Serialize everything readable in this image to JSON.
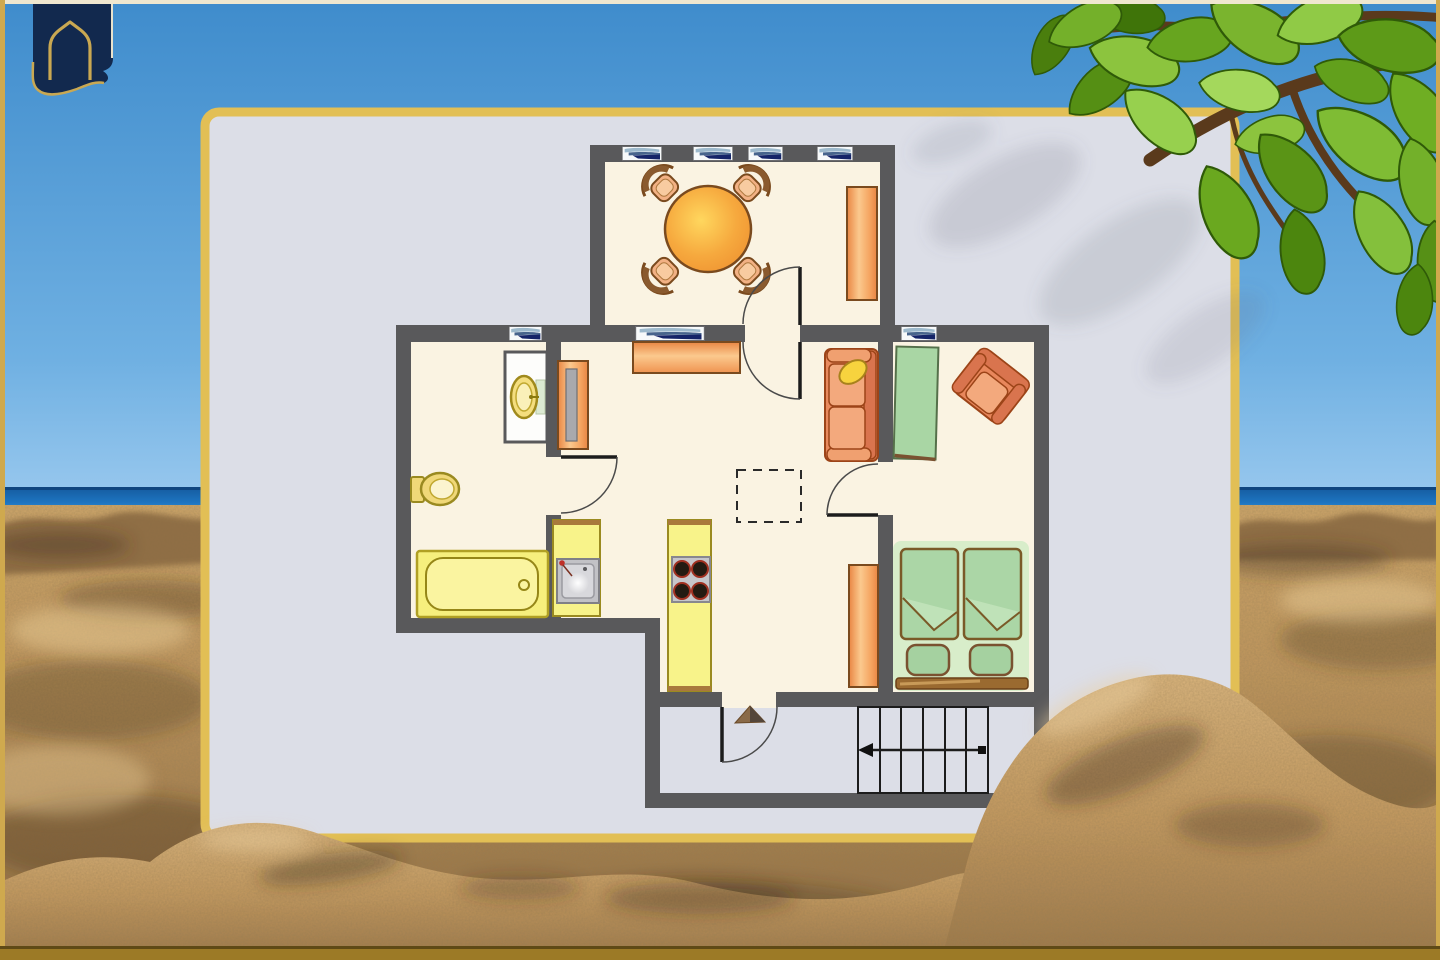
{
  "scene": {
    "description": "sunny beach photo backdrop (blue sky, sea horizon, sandy dunes) with an apartment floor-plan card, tropical leaves top-right and a navy arch logo top-left",
    "background_elements": [
      "sky",
      "sea-horizon",
      "sandy-beach",
      "tree-branch-leaves",
      "leaf-shadow-on-card"
    ],
    "logo": {
      "icon": "arched-banner-logo"
    }
  },
  "colors": {
    "sky_top": "#4390cf",
    "sky_bottom": "#94c4ea",
    "sea": "#1d68b2",
    "sea_horizon_line": "#10457e",
    "sand_light": "#d8b37b",
    "sand_mid": "#c49a62",
    "sand_dark": "#8a6840",
    "card_bg": "#dcdee7",
    "card_border": "#e2bf55",
    "wall": "#59595b",
    "floor": "#faf3e2",
    "line_black": "#1c1c1c",
    "window_navy": "#152468",
    "window_blue": "#9db9cc",
    "furniture_orange": "#ef9350",
    "furniture_outline": "#8a4a1e",
    "green": "#a9d6a4",
    "green_glow": "#d8edca",
    "yellow": "#f6ef8a",
    "metal": "#c2c2c6",
    "leaf_green": "#76b42a",
    "branch_brown": "#5a3a1c",
    "logo_navy": "#12294e",
    "logo_gold": "#c9a852"
  },
  "floor_plan": {
    "style": "hand-tinted 2D apartment plan, no text labels",
    "rooms": [
      {
        "name": "dining-room",
        "windows": 4,
        "furniture": [
          "round-dining-table",
          "dining-chair",
          "dining-chair",
          "dining-chair",
          "dining-chair",
          "sideboard"
        ]
      },
      {
        "name": "hallway",
        "windows": 1,
        "furniture": [
          "sideboard",
          "mirror-wardrobe",
          "sofa",
          "ceiling-hatch-dashed-square"
        ]
      },
      {
        "name": "bathroom",
        "windows": 1,
        "furniture": [
          "washbasin",
          "toilet",
          "bathtub"
        ]
      },
      {
        "name": "kitchen",
        "windows": 0,
        "furniture": [
          "sink-counter",
          "stove-counter-4-burners"
        ]
      },
      {
        "name": "living-area",
        "windows": 1,
        "furniture": [
          "green-rug",
          "armchair"
        ]
      },
      {
        "name": "bedroom",
        "windows": 0,
        "furniture": [
          "wardrobe",
          "single-bed",
          "single-bed",
          "headboard-bench"
        ]
      },
      {
        "name": "stair-landing",
        "windows": 0,
        "furniture": [
          "entry-direction-triangle",
          "staircase"
        ]
      }
    ],
    "windows_total": 7,
    "doors_total": 5,
    "staircase": {
      "steps": 6,
      "arrow_direction": "left"
    }
  }
}
